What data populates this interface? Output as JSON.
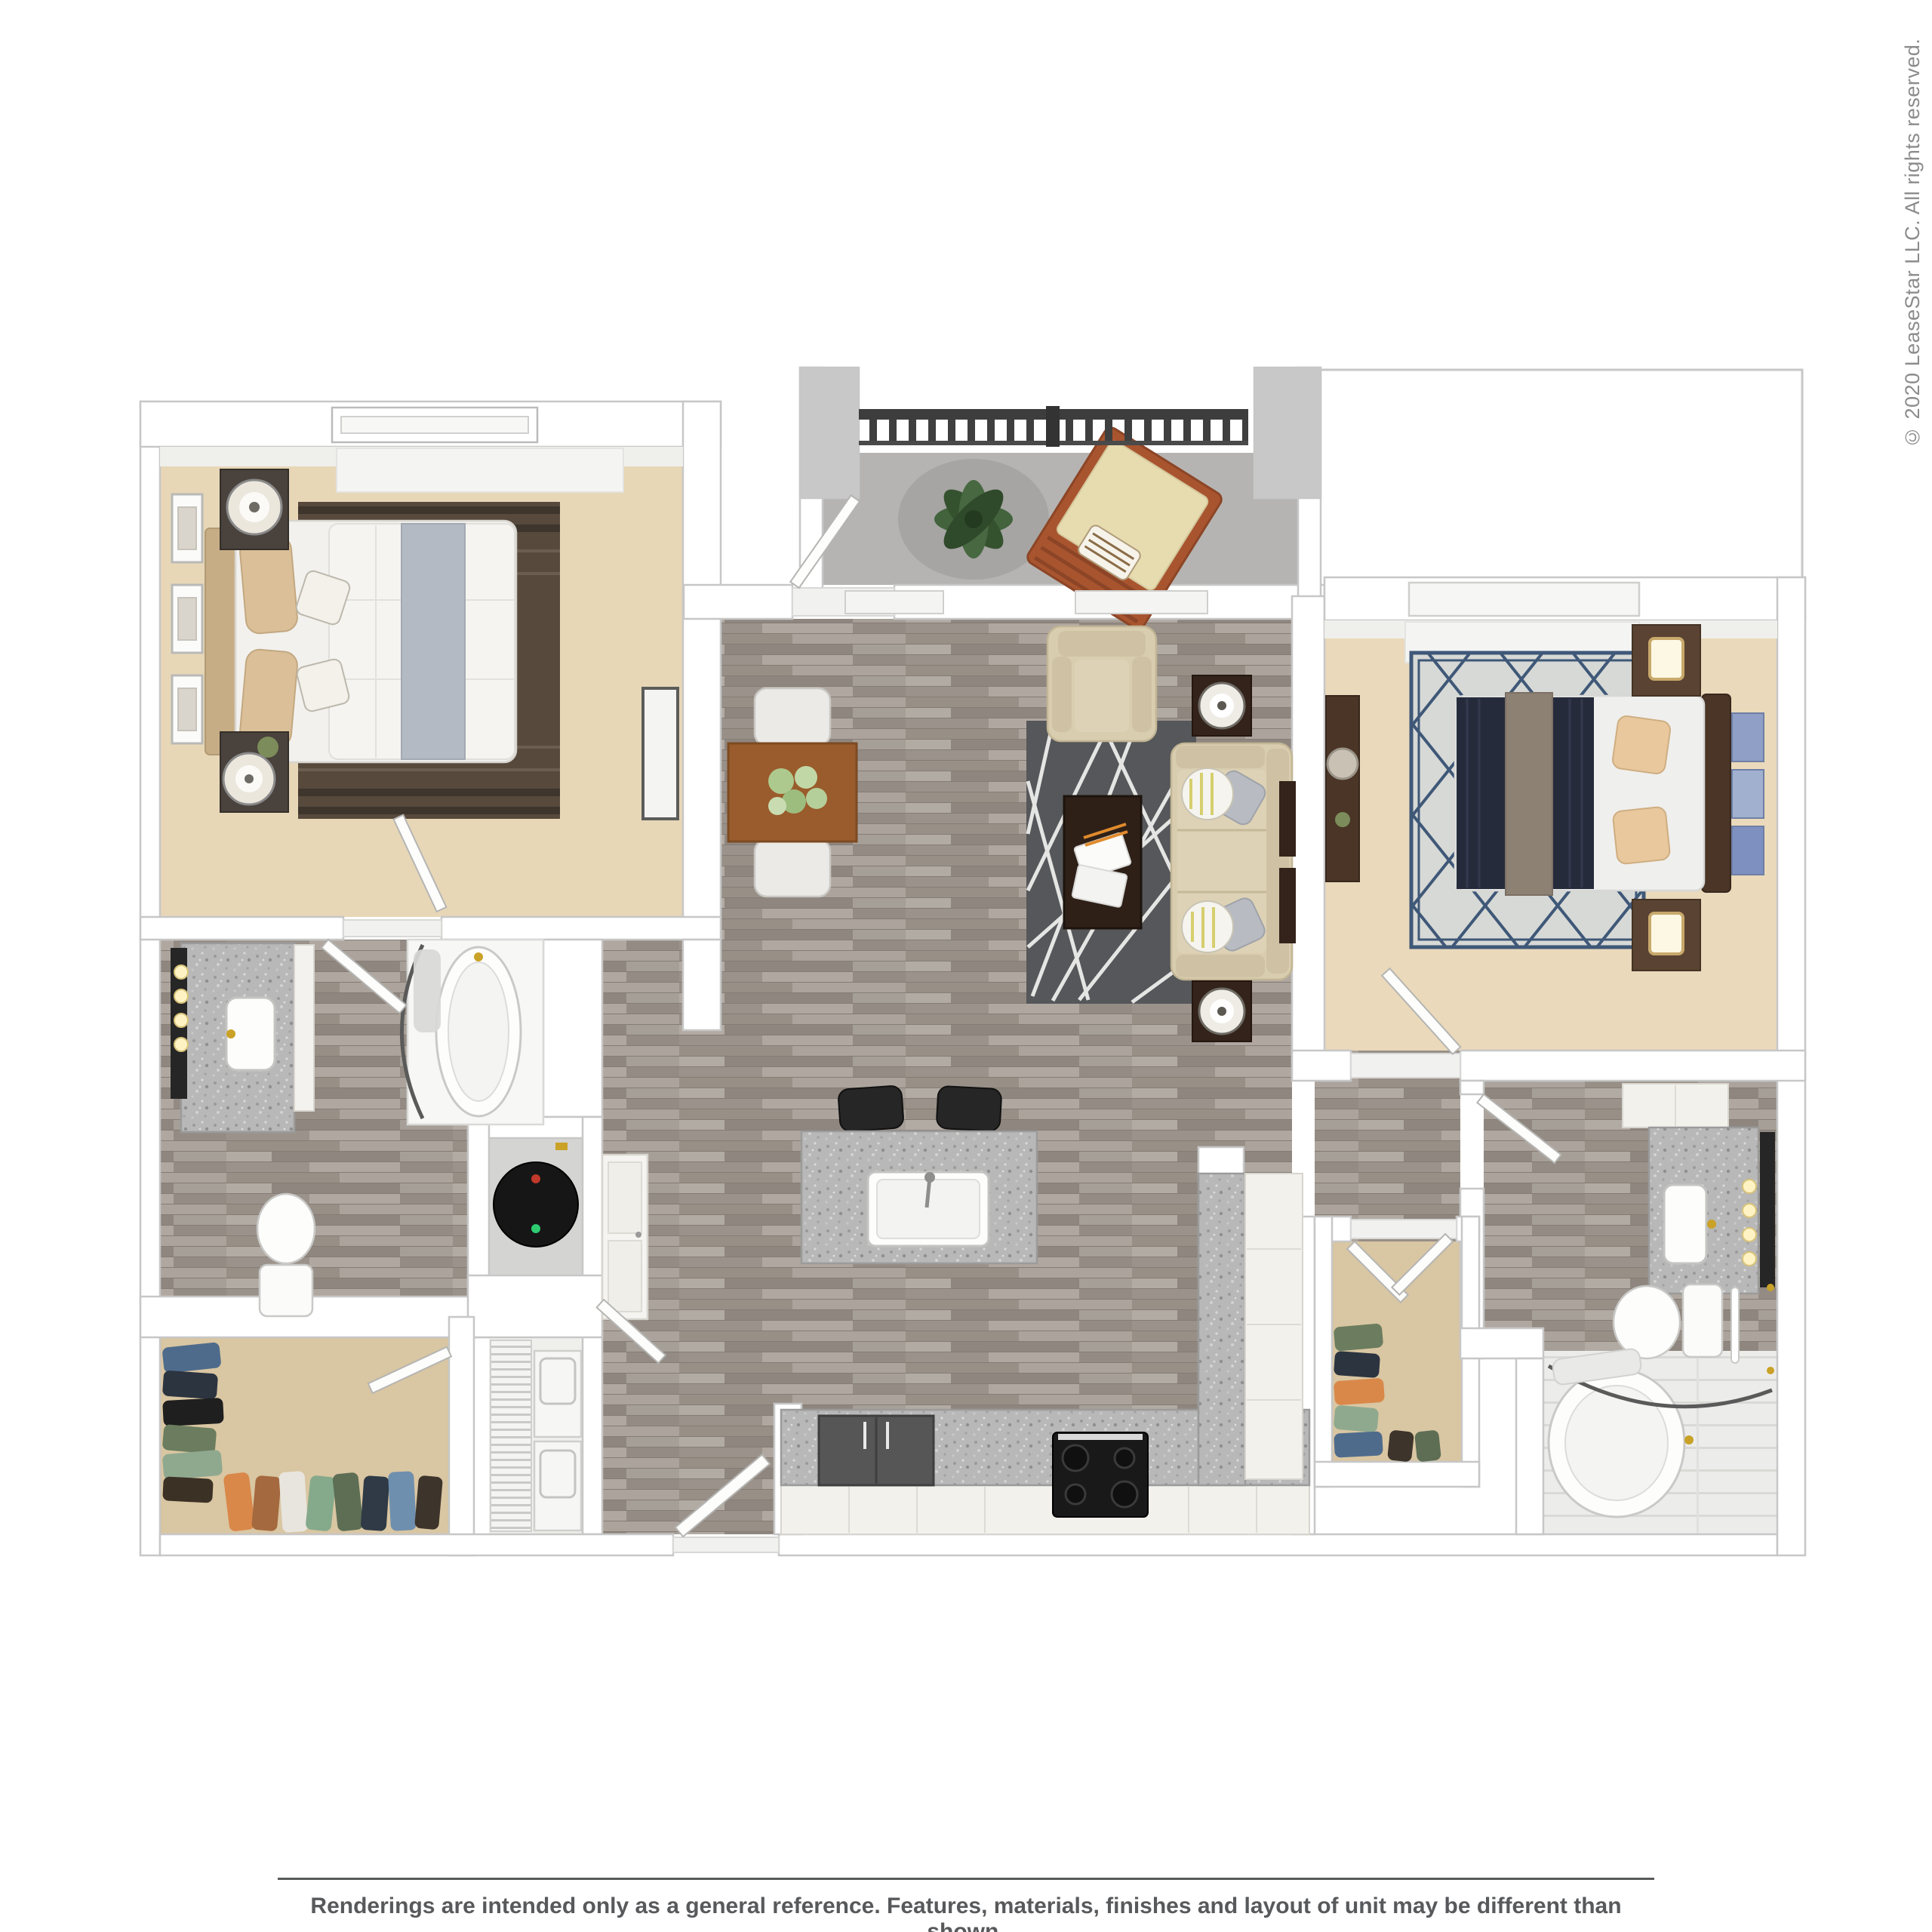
{
  "watermark": {
    "text": "© 2020 LeaseStar LLC. All rights reserved.",
    "color": "#8c8c8c"
  },
  "footer": {
    "disclaimer": "Renderings are intended only as a general reference. Features, materials, finishes and layout of unit may be different than shown.",
    "color": "#58595b"
  },
  "floor_plan": {
    "description": "3D top-down rendering of a two-bedroom, two-bathroom apartment floor plan with balcony",
    "rooms": [
      {
        "name": "master-bedroom",
        "floor": "beige carpet",
        "items": [
          "queen bed with white duvet and gray runner",
          "tan headboard",
          "striped brown area rug",
          "two dark nightstands with round lamps",
          "three wall frames",
          "window",
          "wall panel"
        ]
      },
      {
        "name": "balcony",
        "floor": "gray concrete",
        "items": [
          "dark metal railing",
          "potted plant on round mat",
          "wood lounge chair with beige cushion"
        ]
      },
      {
        "name": "bedroom-2",
        "floor": "beige carpet",
        "items": [
          "bed with navy blanket and taupe runner",
          "diamond-lattice rug",
          "two dark wood nightstands with lamps",
          "dresser",
          "three blue art panels",
          "window"
        ]
      },
      {
        "name": "living-dining-room",
        "floor": "gray plank wood",
        "items": [
          "dining table with flowers",
          "two white dining chairs",
          "dark gray rug with white lines",
          "beige sofa with accent pillows",
          "beige armchair",
          "dark coffee table with magazines",
          "two end tables with lamps",
          "wall shelves"
        ]
      },
      {
        "name": "kitchen",
        "floor": "gray plank wood",
        "items": [
          "granite island with sink",
          "two black bar stools",
          "refrigerator",
          "range with cooktop",
          "L-shaped granite counter with white cabinets",
          "linen cabinet"
        ]
      },
      {
        "name": "master-bathroom",
        "floor": "gray plank wood",
        "items": [
          "granite vanity with sink",
          "mirror with four vanity lights",
          "oval soaking tub with curved shower rod",
          "toilet"
        ]
      },
      {
        "name": "bathroom-2",
        "floor": "gray plank wood",
        "items": [
          "granite vanity with sink",
          "mirror with four vanity lights",
          "upper cabinets",
          "toilet",
          "towel bar",
          "oval tub on white tile",
          "curved shower rod"
        ]
      },
      {
        "name": "walk-in-closet-1",
        "floor": "beige carpet",
        "items": [
          "hanging clothes"
        ]
      },
      {
        "name": "walk-in-closet-2",
        "floor": "beige carpet",
        "items": [
          "hanging clothes"
        ]
      },
      {
        "name": "laundry-closet",
        "floor": "vinyl",
        "items": [
          "wire shelving",
          "washer",
          "dryer"
        ]
      },
      {
        "name": "water-heater-closet",
        "floor": "concrete",
        "items": [
          "water heater"
        ]
      },
      {
        "name": "entry-hall",
        "floor": "gray plank wood",
        "items": [
          "front door",
          "linen cabinet"
        ]
      }
    ],
    "palette": {
      "wall": "#ffffff",
      "wall_edge": "#c7c7c7",
      "carpet_bedroom": "#e7d7b7",
      "carpet_closet": "#d9c6a2",
      "wood_floor": "#a49d95",
      "balcony_concrete": "#b5b4b2",
      "granite": "#b8b8b8",
      "living_rug": "#55575a",
      "bedroom2_rug": "#d7d9d6",
      "lattice_navy": "#3f5878",
      "master_rug": "#57493c",
      "sofa_beige": "#d9cdb0",
      "table_wood": "#9a5c2c",
      "dark_wood": "#33231a",
      "navy_blanket": "#262b3c",
      "railing": "#3f3f3f",
      "appliance_black": "#191919"
    }
  }
}
